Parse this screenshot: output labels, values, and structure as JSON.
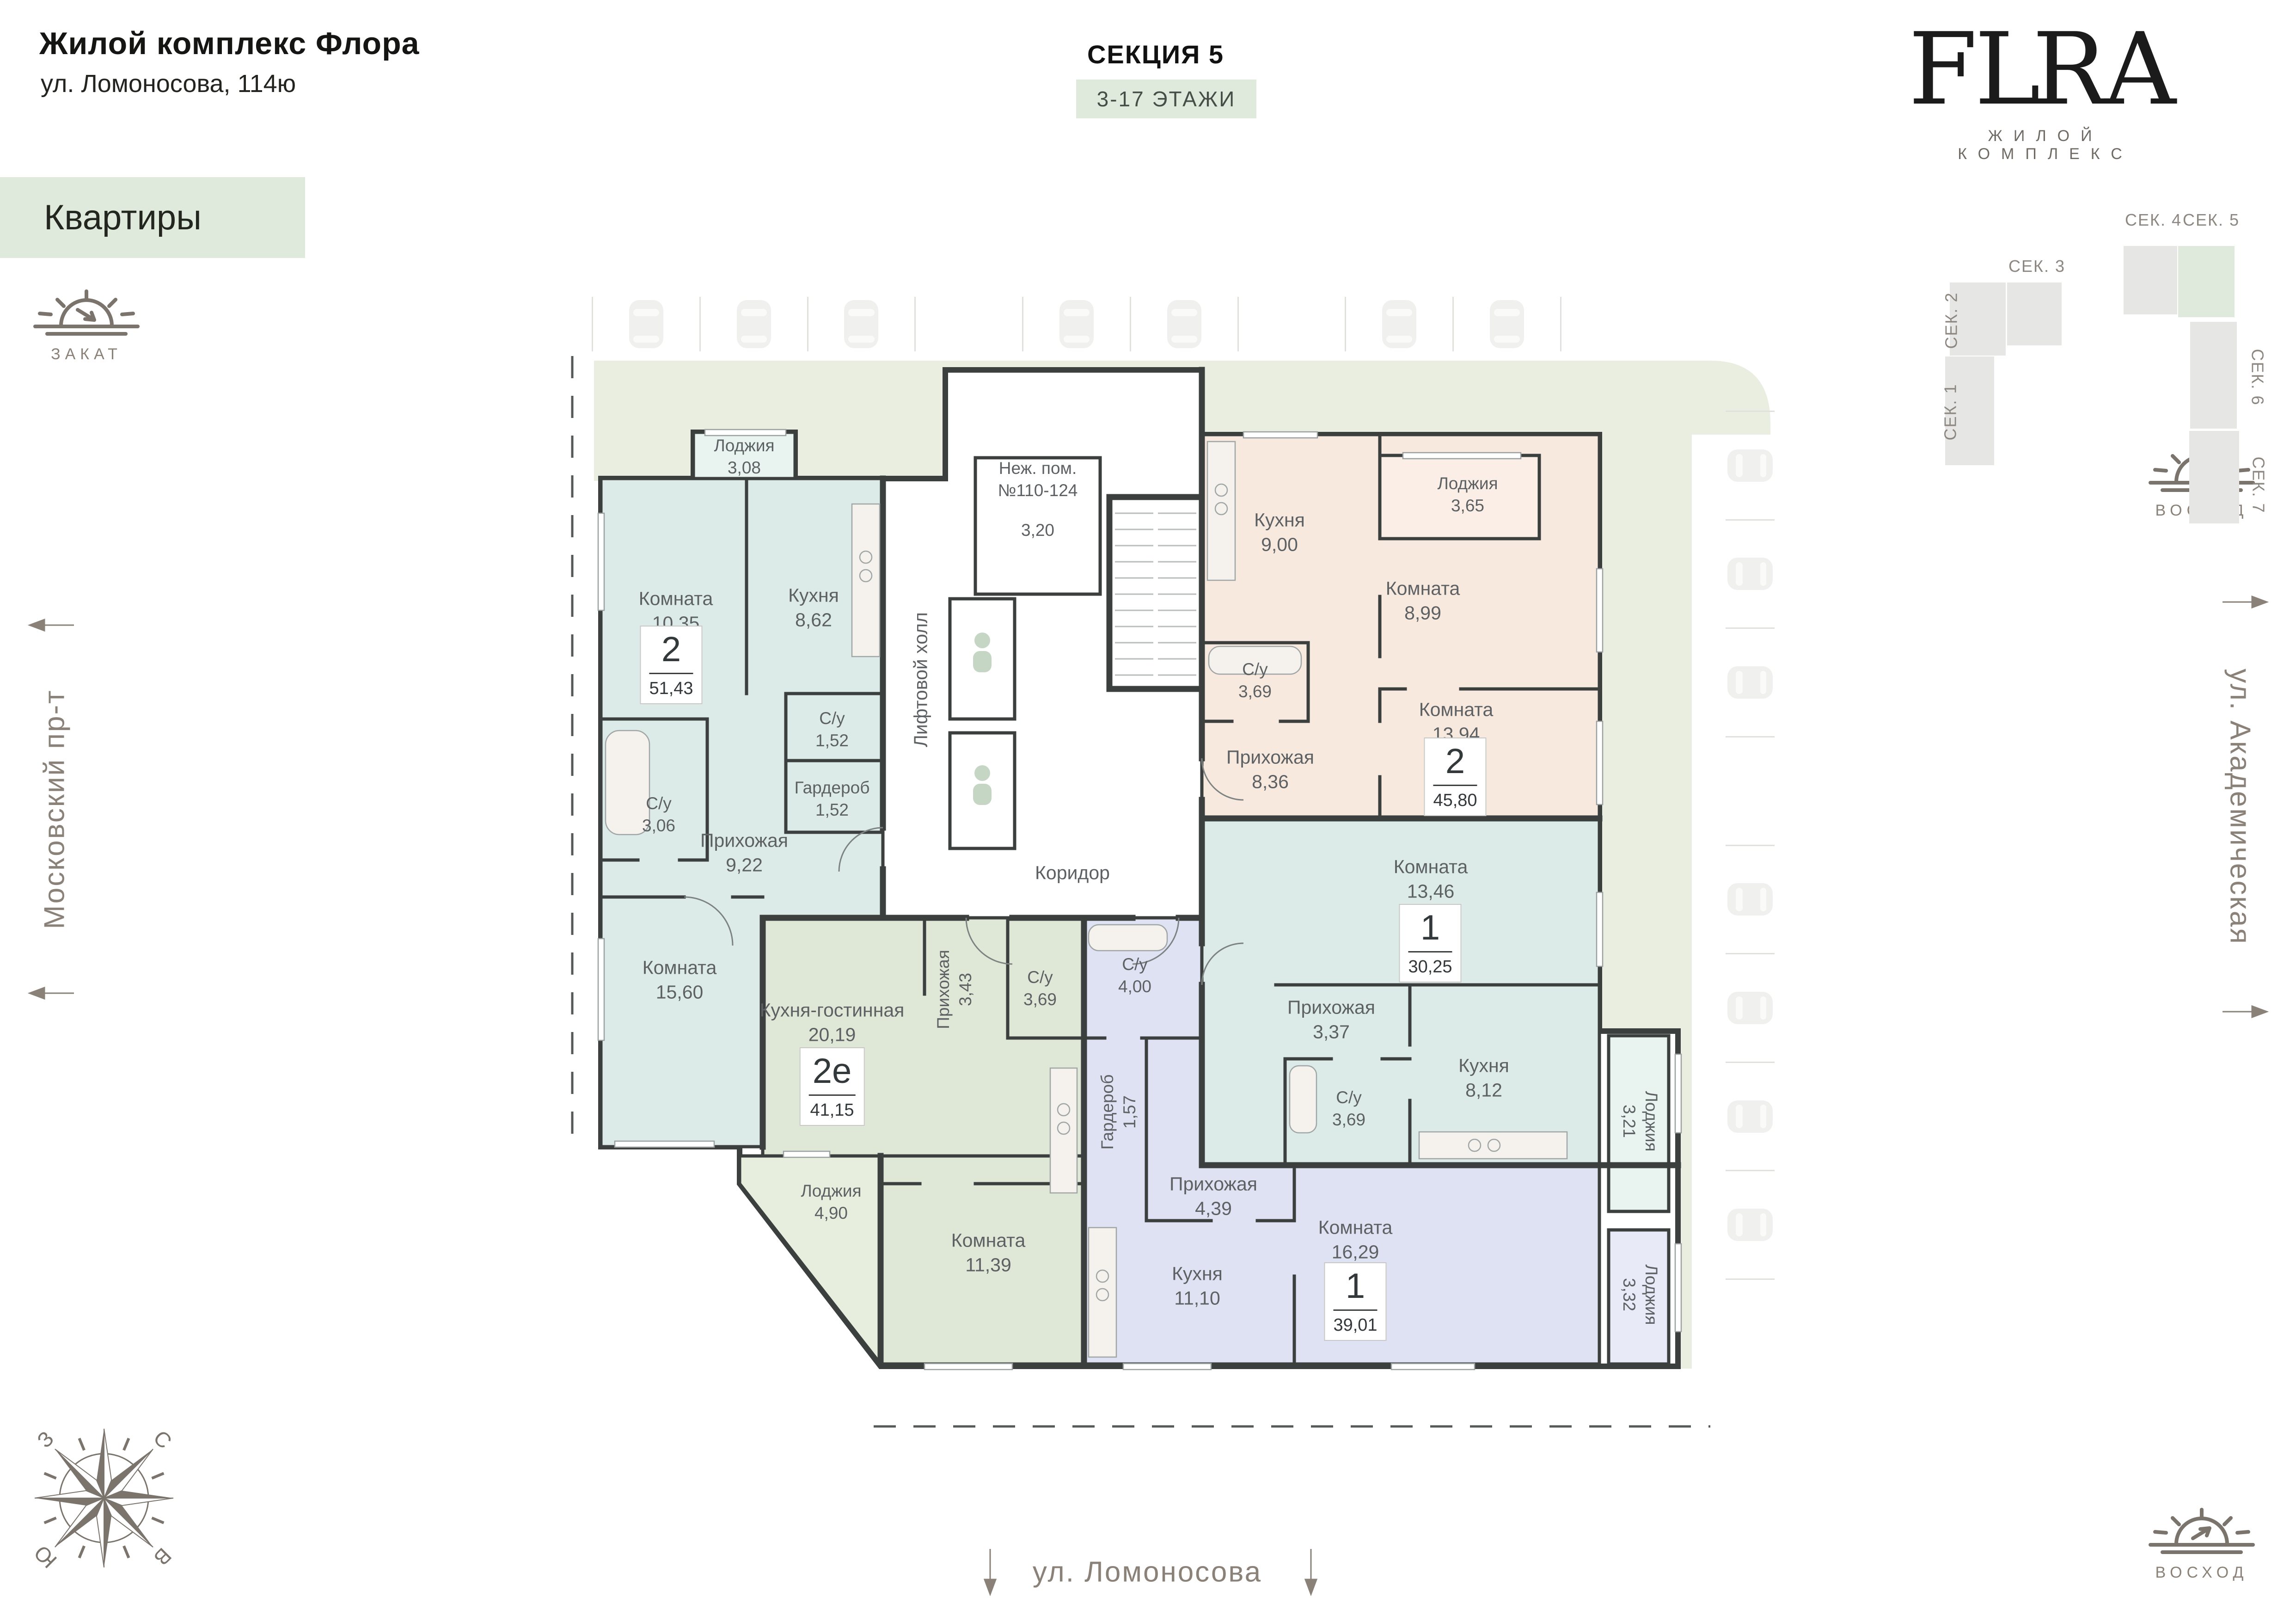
{
  "header": {
    "title": "Жилой комплекс Флора",
    "address": "ул. Ломоносова, 114ю",
    "category_label": "Квартиры"
  },
  "section_info": {
    "title": "СЕКЦИЯ 5",
    "floors": "3-17 ЭТАЖИ"
  },
  "logo": {
    "brand_left": "FL",
    "brand_right": "RA",
    "tagline": "ЖИЛОЙ КОМПЛЕКС"
  },
  "minimap": {
    "active": "СЕК. 5",
    "sections": [
      {
        "label": "СЕК. 1"
      },
      {
        "label": "СЕК. 2"
      },
      {
        "label": "СЕК. 3"
      },
      {
        "label": "СЕК. 4"
      },
      {
        "label": "СЕК. 5"
      },
      {
        "label": "СЕК. 6"
      },
      {
        "label": "СЕК. 7"
      }
    ]
  },
  "orientation": {
    "sunset_label": "ЗАКАТ",
    "sunrise_label": "ВОСХОД",
    "compass": {
      "north": "С",
      "east": "В",
      "south": "Ю",
      "west": "З"
    }
  },
  "streets": {
    "left": "Московский пр-т",
    "right": "ул. Академическая",
    "bottom": "ул. Ломоносова"
  },
  "core": {
    "nonres_line1": "Неж. пом.",
    "nonres_line2": "№110-124",
    "nonres_area": "3,20",
    "elevator_hall": "Лифтовой холл",
    "corridor": "Коридор"
  },
  "apartments": [
    {
      "id": "apt-2-5143",
      "type": "2",
      "area": "51,43",
      "rooms": [
        {
          "name": "Лоджия",
          "area": "3,08"
        },
        {
          "name": "Комната",
          "area": "10,35"
        },
        {
          "name": "Кухня",
          "area": "8,62"
        },
        {
          "name": "С/у",
          "area": "1,52"
        },
        {
          "name": "Гардероб",
          "area": "1,52"
        },
        {
          "name": "С/у",
          "area": "3,06"
        },
        {
          "name": "Прихожая",
          "area": "9,22"
        },
        {
          "name": "Комната",
          "area": "15,60"
        }
      ]
    },
    {
      "id": "apt-2e-4115",
      "type": "2е",
      "area": "41,15",
      "rooms": [
        {
          "name": "Кухня-гостинная",
          "area": "20,19"
        },
        {
          "name": "Прихожая",
          "area": "3,43"
        },
        {
          "name": "С/у",
          "area": "3,69"
        },
        {
          "name": "Лоджия",
          "area": "4,90"
        },
        {
          "name": "Комната",
          "area": "11,39"
        }
      ]
    },
    {
      "id": "apt-2-4580",
      "type": "2",
      "area": "45,80",
      "rooms": [
        {
          "name": "Кухня",
          "area": "9,00"
        },
        {
          "name": "Лоджия",
          "area": "3,65"
        },
        {
          "name": "Комната",
          "area": "8,99"
        },
        {
          "name": "С/у",
          "area": "3,69"
        },
        {
          "name": "Прихожая",
          "area": "8,36"
        },
        {
          "name": "Комната",
          "area": "13,94"
        }
      ]
    },
    {
      "id": "apt-1-3025",
      "type": "1",
      "area": "30,25",
      "rooms": [
        {
          "name": "Комната",
          "area": "13,46"
        },
        {
          "name": "Прихожая",
          "area": "3,37"
        },
        {
          "name": "С/у",
          "area": "3,69"
        },
        {
          "name": "Кухня",
          "area": "8,12"
        },
        {
          "name": "Лоджия",
          "area": "3,21"
        }
      ]
    },
    {
      "id": "apt-1-3901",
      "type": "1",
      "area": "39,01",
      "rooms": [
        {
          "name": "С/у",
          "area": "4,00"
        },
        {
          "name": "Гардероб",
          "area": "1,57"
        },
        {
          "name": "Прихожая",
          "area": "4,39"
        },
        {
          "name": "Кухня",
          "area": "11,10"
        },
        {
          "name": "Комната",
          "area": "16,29"
        },
        {
          "name": "Лоджия",
          "area": "3,32"
        }
      ]
    }
  ],
  "parking": {
    "top_slots": 9,
    "top_cars_in_slots": [
      1,
      2,
      3,
      5,
      6,
      8,
      9
    ],
    "side_slots": 8,
    "side_cars_in_slots": [
      1,
      2,
      3,
      5,
      6,
      7,
      8
    ]
  },
  "colors": {
    "wall": "#3b3f3e",
    "olive_bg": "#eaeee1",
    "accent_green_bg": "#dfe9dc",
    "teal": "#dcebe8",
    "teal_light": "#e9f4f1",
    "green": "#dfe7d6",
    "green_light": "#e7eedd",
    "beige": "#f8e9df",
    "beige_light": "#faeee6",
    "lavender": "#dfe2f2",
    "lavender_light": "#e8eaf7",
    "gold": "#c9a159",
    "muted_text": "#8a8178",
    "label_text": "#5d6163"
  }
}
